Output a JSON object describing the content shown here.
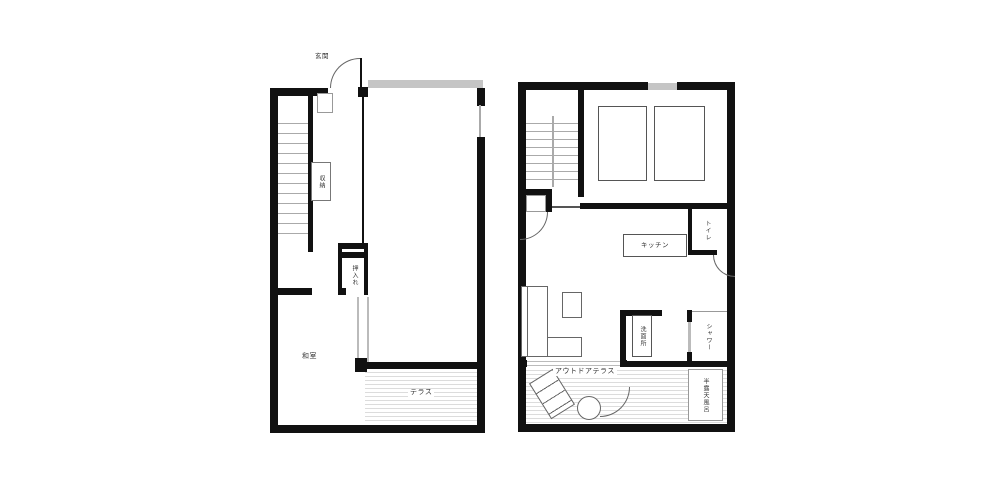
{
  "page": {
    "background": "#ffffff"
  },
  "colors": {
    "wall": "#111111",
    "line": "#666666",
    "stair_line": "#aaaaaa",
    "deck_line": "#dcdcdc",
    "gray_band": "#c5c5c5",
    "glass_door": "#bbbbbb"
  },
  "floorplans": {
    "left": {
      "labels": {
        "entrance": "玄関",
        "storage": "収納",
        "closet": "押入れ",
        "japanese_room": "和室",
        "terrace": "テラス"
      }
    },
    "right": {
      "labels": {
        "kitchen": "キッチン",
        "toilet": "トイレ",
        "washroom": "洗面所",
        "shower": "シャワー",
        "outdoor_terrace": "アウトドアテラス",
        "open_air_bath": "半露天風呂"
      }
    }
  }
}
